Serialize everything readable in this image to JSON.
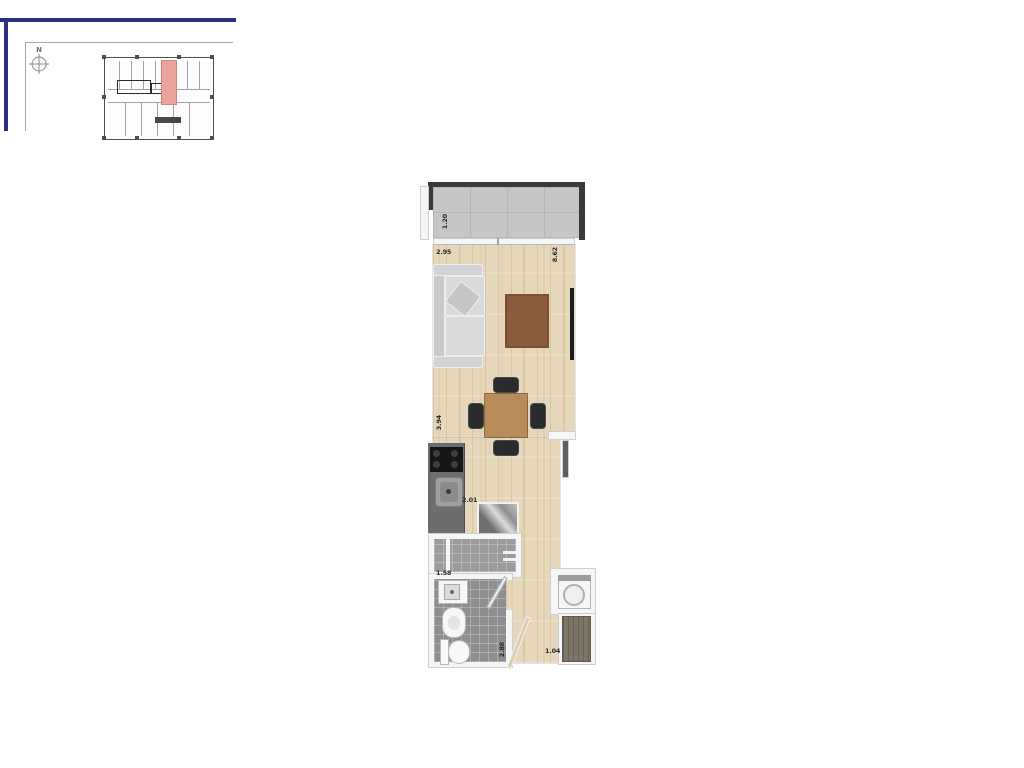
{
  "north": {
    "label": "N"
  },
  "dims": {
    "balcony_depth": "1.20",
    "living_width": "2.95",
    "apartment_length": "8.62",
    "dining_length": "3.94",
    "kitchen_width": "2.01",
    "bath_width": "1.58",
    "hall_length": "2.88",
    "entry_width": "1.04"
  },
  "colors": {
    "accent_navy": "#2c2f80",
    "unit_highlight": "#eba49c",
    "wood_floor": "#e7d7ba",
    "tile_floor": "#8e8e90",
    "concrete": "#c6c6c8",
    "wall_dark": "#3a3a3c",
    "rug_brown": "#8a5c3d",
    "table_wood": "#b78b5a"
  }
}
